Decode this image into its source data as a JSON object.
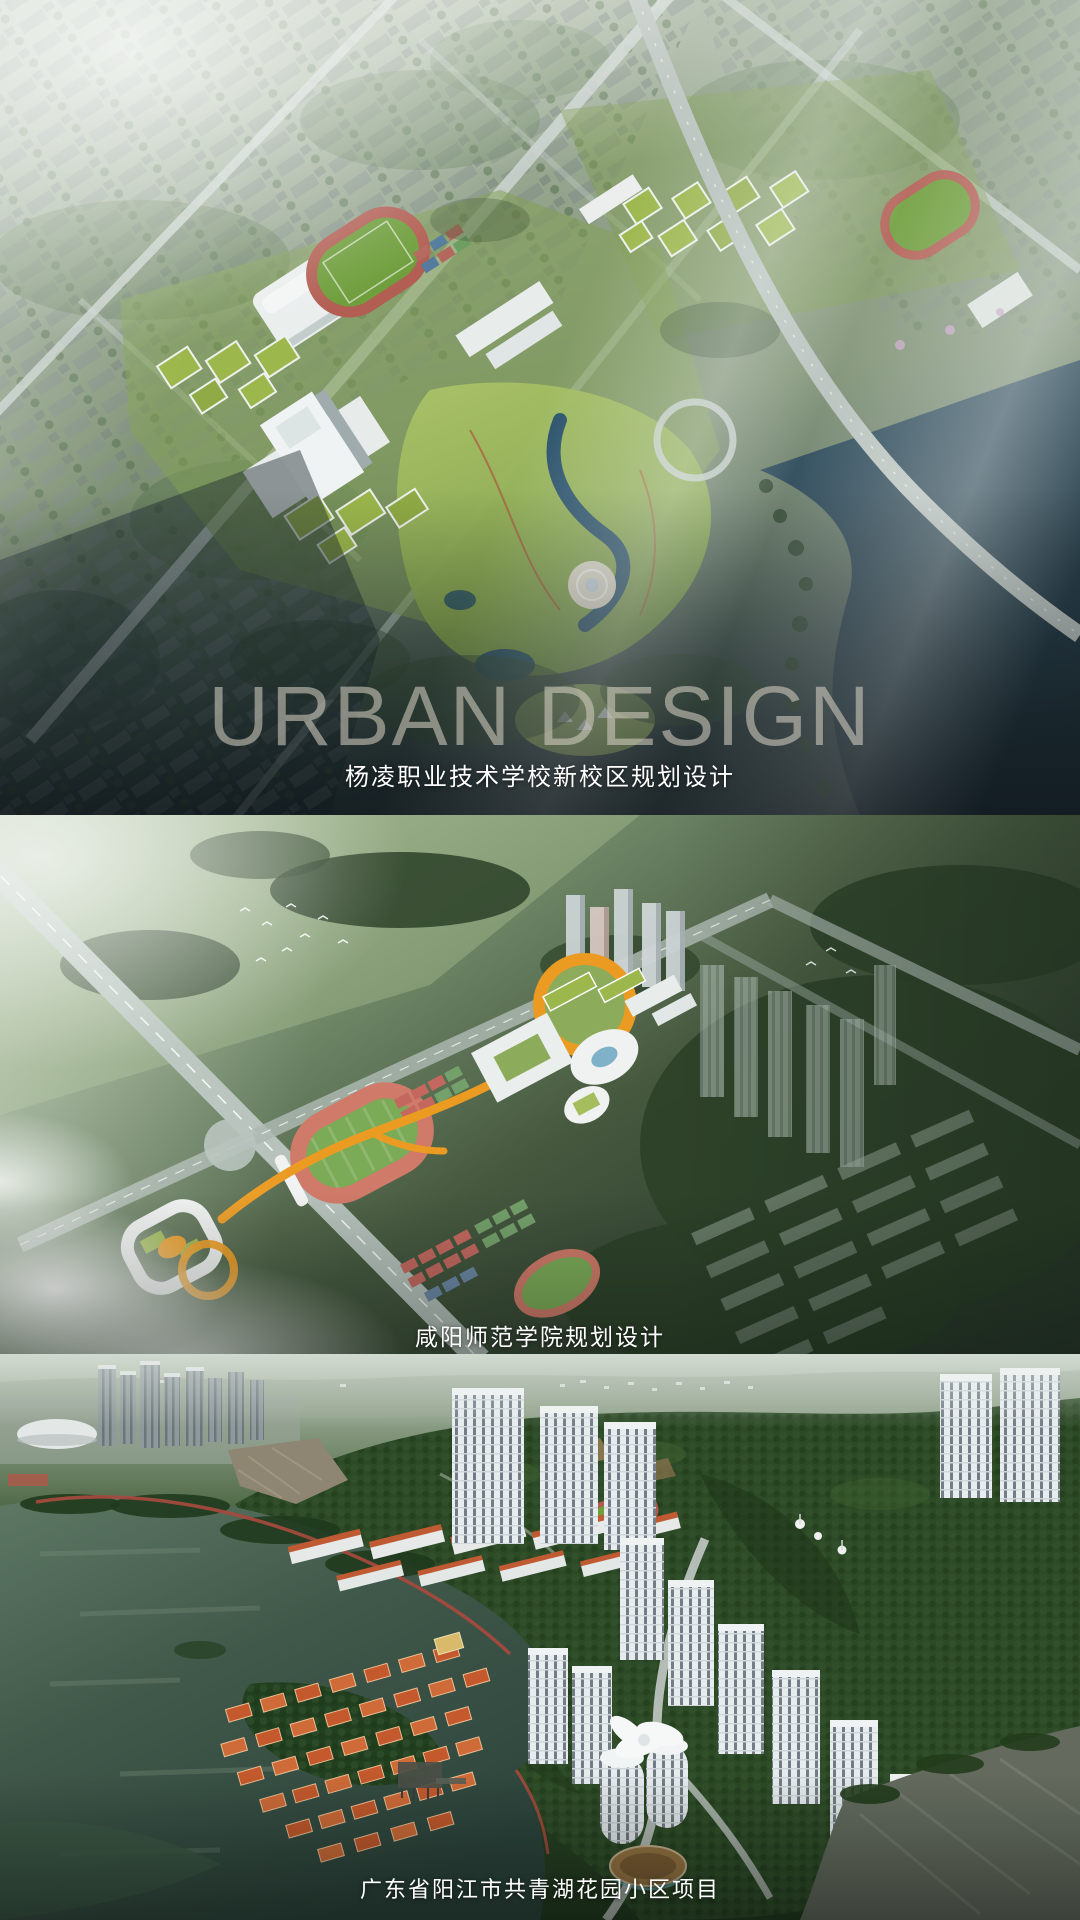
{
  "poster": {
    "watermark": "URBAN DESIGN",
    "panels": [
      {
        "name": "yangling-campus",
        "caption": "杨凌职业技术学校新校区规划设计"
      },
      {
        "name": "xianyang-normal-college",
        "caption": "咸阳师范学院规划设计"
      },
      {
        "name": "gongqing-lake-garden",
        "caption": "广东省阳江市共青湖花园小区项目"
      }
    ],
    "colors": {
      "caption_text": "#FFFFFF",
      "watermark_text": "rgba(210,205,192,0.58)",
      "accent_orange": "#EC9B22",
      "track_red": "#C4685F",
      "pitch_green": "#6F9E3C",
      "lake_teal": "#16303E",
      "mountain_green": "#2C4A26",
      "villa_roof_orange": "#C3592C",
      "fog_white": "#E8EEEC"
    }
  }
}
